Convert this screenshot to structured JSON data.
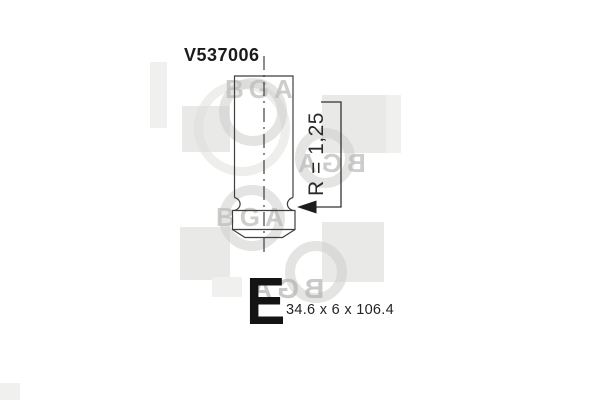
{
  "part": {
    "number": "V537006",
    "valve_type_letter": "E",
    "dimensions": "34.6 x 6 x 106.4",
    "radius_label": "R = 1,25"
  },
  "watermark": {
    "brand": "BGA"
  },
  "colors": {
    "drawing_line": "#3f3f3f",
    "arrow_fill": "#1d1d1d",
    "label_text": "#1e1e1e",
    "watermark_gray": "#d7d7d5",
    "background": "#ffffff"
  }
}
